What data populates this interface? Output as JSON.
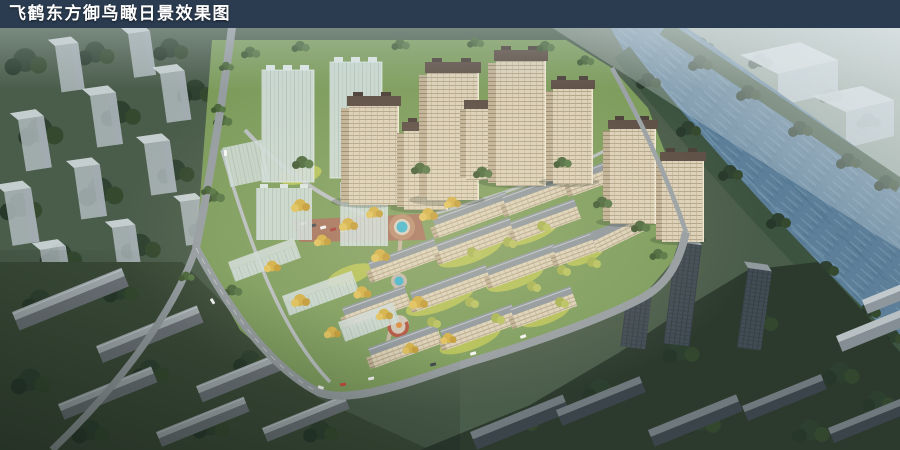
{
  "title_bar": {
    "text": "飞鹤东方御鸟瞰日景效果图"
  },
  "palette": {
    "titlebar": "#2b3c50",
    "titletext": "#ffffff",
    "water": "#5d7f99",
    "waterlight": "#7da0b6",
    "farshore": "#95a49a",
    "contextgreen": "#4a5c4a",
    "contextdark": "#2c3a2e",
    "sitegreen": "#7d9c5c",
    "lawnbright": "#b9c557",
    "treedark": "#2e4130",
    "treeyellow": "#d2ae44",
    "tanfacade": "#dcd1b9",
    "tanshade": "#c1b196",
    "towerroof": "#5d4e45",
    "slabroof": "#8e969d",
    "ghost": "#d0dcd9",
    "darktower": "#424c54",
    "road": "#969da1",
    "plaza": "#a4705a",
    "pool": "#3fb3cd"
  }
}
